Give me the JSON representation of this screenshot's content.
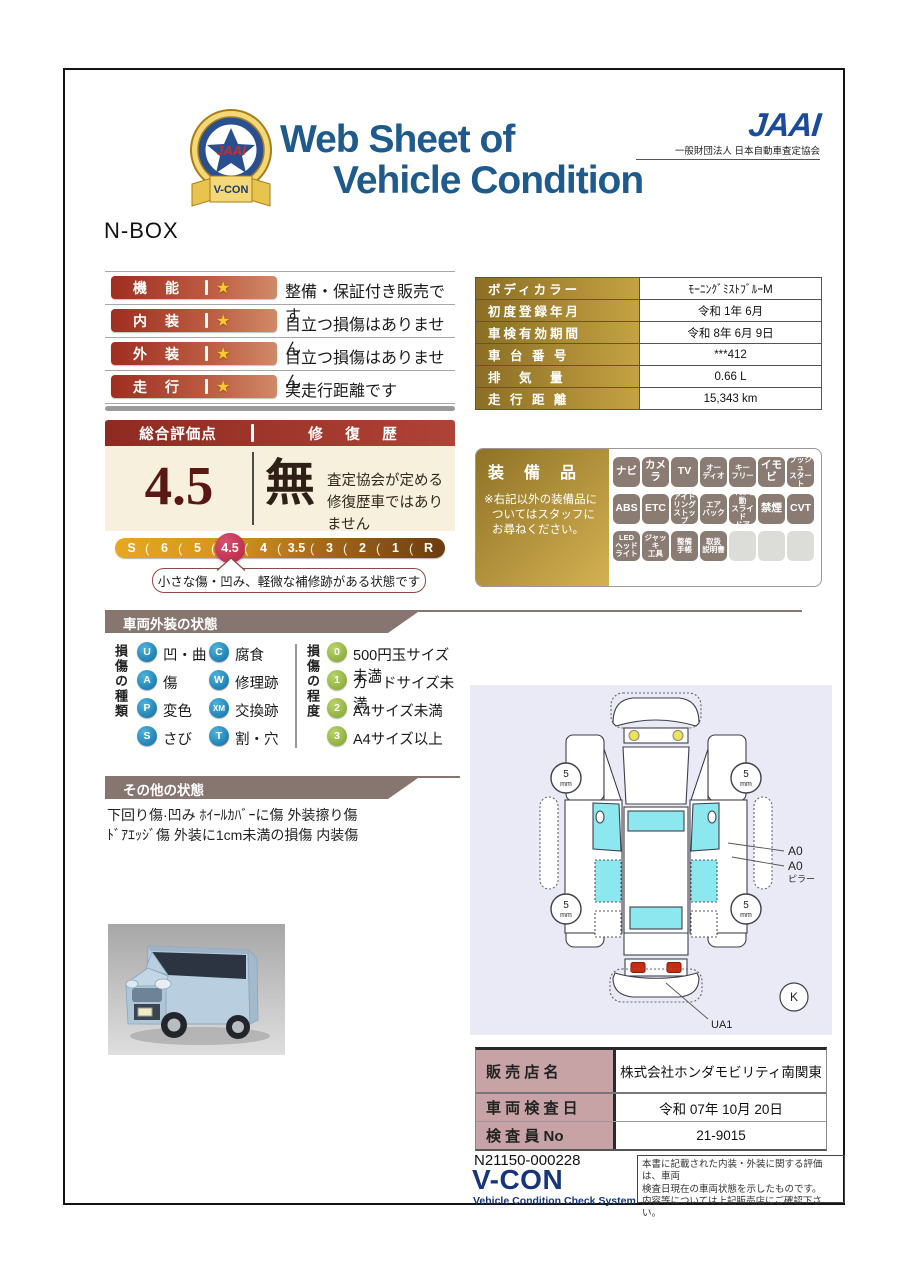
{
  "header": {
    "badge": {
      "jaai": "JAAI",
      "vcon": "V-CON"
    },
    "title_line1": "Web Sheet of",
    "title_line2": "Vehicle Condition",
    "jaai_wordmark": "JAAI",
    "jaai_subtitle": "一般財団法人 日本自動車査定協会",
    "model": "N-BOX"
  },
  "ratings": {
    "star": "★",
    "rows": [
      {
        "label": "機　能",
        "text": "整備・保証付き販売です"
      },
      {
        "label": "内　装",
        "text": "目立つ損傷はありません"
      },
      {
        "label": "外　装",
        "text": "目立つ損傷はありません"
      },
      {
        "label": "走　行",
        "text": "実走行距離です"
      }
    ]
  },
  "info_table": {
    "rows": [
      {
        "label": "ボディカラー",
        "value": "ﾓｰﾆﾝｸﾞﾐｽﾄﾌﾞﾙｰM"
      },
      {
        "label": "初度登録年月",
        "value": "令和 1年 6月"
      },
      {
        "label": "車検有効期間",
        "value": "令和 8年 6月 9日"
      },
      {
        "label": "車 台 番 号",
        "value": "***412"
      },
      {
        "label": "排　気　量",
        "value": "0.66 L"
      },
      {
        "label": "走 行 距 離",
        "value": "15,343 km"
      }
    ]
  },
  "score": {
    "header_left": "総合評価点",
    "header_right": "修　復　歴",
    "value": "4.5",
    "repair_status": "無",
    "repair_desc_line1": "査定協会が定める",
    "repair_desc_line2": "修復歴車ではありません",
    "scale": [
      "S",
      "6",
      "5",
      "4.5",
      "4",
      "3.5",
      "3",
      "2",
      "1",
      "R"
    ],
    "selected": "4.5",
    "callout": "小さな傷・凹み、軽微な補修跡がある状態です"
  },
  "equipment": {
    "title": "装　備　品",
    "note_line1": "※右記以外の装備品に",
    "note_line2": "ついてはスタッフに",
    "note_line3": "お尋ねください。",
    "rows": [
      [
        "ナビ",
        "カメラ",
        "TV",
        "オー\nディオ",
        "キー\nフリー",
        "イモビ",
        "プッシュ\nスタート"
      ],
      [
        "ABS",
        "ETC",
        "アイド\nリング\nストップ",
        "エア\nバック",
        "片側電動\nスライド\nドア",
        "禁煙",
        "CVT"
      ],
      [
        "LED\nヘッド\nライト",
        "ジャッキ\n工具",
        "整備\n手帳",
        "取扱\n説明書",
        "",
        "",
        ""
      ]
    ]
  },
  "exterior": {
    "title": "車両外装の状態",
    "type_label": "損傷の種類",
    "types": [
      {
        "code": "U",
        "label": "凹・曲"
      },
      {
        "code": "C",
        "label": "腐食"
      },
      {
        "code": "A",
        "label": "傷"
      },
      {
        "code": "W",
        "label": "修理跡"
      },
      {
        "code": "P",
        "label": "変色"
      },
      {
        "code": "XM",
        "label": "交換跡"
      },
      {
        "code": "S",
        "label": "さび"
      },
      {
        "code": "T",
        "label": "割・穴"
      }
    ],
    "degree_label": "損傷の程度",
    "degrees": [
      {
        "code": "0",
        "label": "500円玉サイズ未満"
      },
      {
        "code": "1",
        "label": "カードサイズ未満"
      },
      {
        "code": "2",
        "label": "A4サイズ未満"
      },
      {
        "code": "3",
        "label": "A4サイズ以上"
      }
    ]
  },
  "other": {
    "title": "その他の状態",
    "line1": "下回り傷·凹み ﾎｲｰﾙｶﾊﾞｰに傷 外装擦り傷",
    "line2": "ﾄﾞｱｴｯｼﾞ傷 外装に1cm未満の損傷 内装傷"
  },
  "diagram": {
    "tread_value": "5",
    "tread_unit": "mm",
    "label_a0_1": "A0",
    "label_a0_2": "A0",
    "label_pillar": "ピラー",
    "label_ua1": "UA1",
    "label_k": "K"
  },
  "dealer": {
    "rows": [
      {
        "label": "販 売 店 名",
        "value": "株式会社ホンダモビリティ南関東"
      },
      {
        "label": "車 両 検 査 日",
        "value": "令和 07年 10月 20日"
      },
      {
        "label": "検 査 員 No",
        "value": "21-9015"
      }
    ]
  },
  "footer": {
    "doc_number": "N21150-000228",
    "vcon": "V-CON",
    "vcon_sub": "Vehicle Condition Check System",
    "disclaimer_line1": "本書に記載された内装・外装に関する評価は、車両",
    "disclaimer_line2": "検査日現在の車両状態を示したものです。",
    "disclaimer_line3": "内容等については上記販売店にご確認下さい。"
  },
  "colors": {
    "title_blue": "#1e5b8c",
    "jaai_navy": "#1c4b9a",
    "accent_red": "#9e2e21",
    "gold": "#b8902f",
    "tab_taupe": "#87766f",
    "scale_selected": "#b5233f",
    "diagram_bg": "#eaeaf6",
    "window_cyan": "#8ce7ef",
    "dealer_pink": "#c7a3a5"
  }
}
